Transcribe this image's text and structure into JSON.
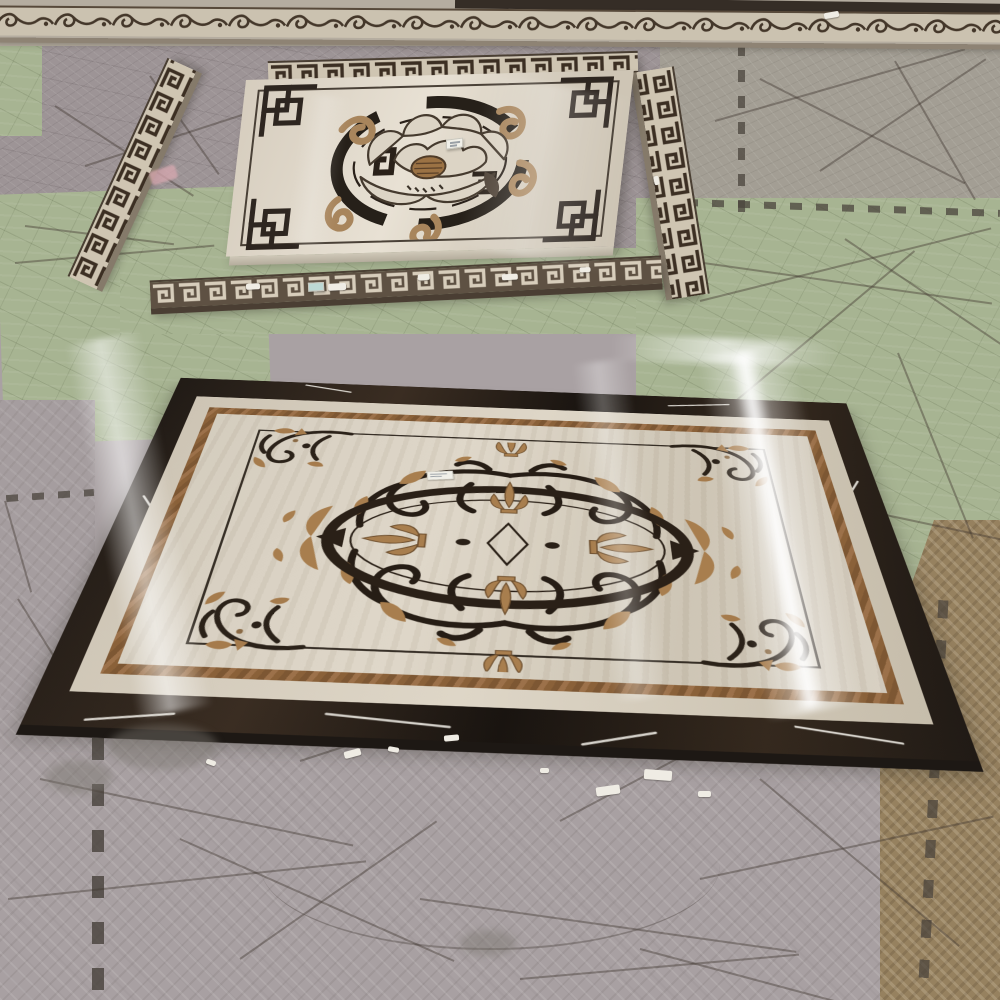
{
  "scene": {
    "type": "photograph",
    "setting": "stone fabrication workshop floor covered with interlocking foam mats scored by cutting lines",
    "camera": "oblique high angle looking down and forward",
    "objects": [
      {
        "name": "scroll-border-strip",
        "description": "long marble border strip with dark scroll-vine inlay, spanning full width at top",
        "colors": [
          "#cbc2b0",
          "#44372a"
        ]
      },
      {
        "name": "square-peony-medallion",
        "description": "square beige marble medallion with Chinese fret corner knots, broken circular ring and outlined peony flower with tan ruyi curls",
        "colors": [
          "#d8cfc0",
          "#2a211a",
          "#a8855c"
        ],
        "sticker": {
          "legible": false
        }
      },
      {
        "name": "greek-key-strip-left-diagonal",
        "description": "waterjet greek-key border strip lying diagonally on mats",
        "colors": [
          "#cfc5b2",
          "#3c2f23"
        ]
      },
      {
        "name": "greek-key-strip-right-vertical",
        "description": "greek-key border strip lying nearly vertical at right of square medallion",
        "colors": [
          "#cfc5b2",
          "#3c2f23"
        ]
      },
      {
        "name": "greek-key-strip-above-square",
        "description": "thin greek-key strip above square medallion",
        "colors": [
          "#cfc5b2",
          "#3c2f23"
        ]
      },
      {
        "name": "greek-key-strip-below-square",
        "description": "worn dark greek-key strip with white paint chips and a pale blue sticker",
        "colors": [
          "#5e5143",
          "#d7cdbb"
        ],
        "sticker": {
          "legible": false
        }
      },
      {
        "name": "rectangular-medallion",
        "description": "large rectangular waterjet marble medallion: dark emperador outer border with white veins, beige band, gold band, beige field, thin dark inner frame with corner floral sprays, central dark oval ring with tan fleur-de-lis cross and acanthus scrollwork",
        "colors": [
          "#241e19",
          "#d5ccbd",
          "#8a6139",
          "#a57b4c"
        ],
        "sticker": {
          "legible": false
        }
      },
      {
        "name": "foam-mats",
        "variants": [
          {
            "name": "mat-mauve-gray",
            "color": "#9d9496"
          },
          {
            "name": "mat-gray",
            "color": "#a39e94"
          },
          {
            "name": "mat-green",
            "color": "#a7b492"
          },
          {
            "name": "mat-bottom-gray-diamond",
            "color": "#a8a0a2"
          },
          {
            "name": "mat-brown-herringbone",
            "color": "#96815f"
          }
        ]
      },
      {
        "name": "debris",
        "description": "white paint chips and gray dust patches near the medallion bottom edge"
      },
      {
        "name": "window-glare",
        "description": "bright vertical reflection streaks across polished marble surfaces"
      }
    ],
    "text_visible_on_screen": "none (sticker labels are illegible at this resolution)"
  }
}
